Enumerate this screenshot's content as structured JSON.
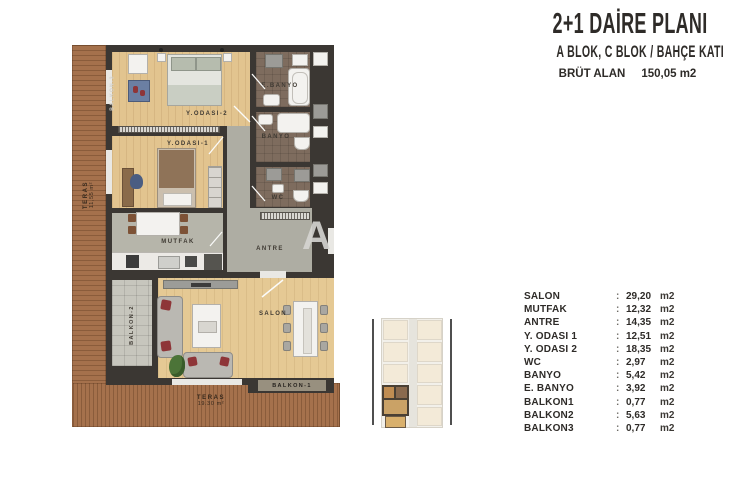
{
  "header": {
    "title": "2+1 DAİRE PLANI",
    "subtitle": "A BLOK, C BLOK / BAHÇE KATI",
    "gross_area_label": "BRÜT ALAN",
    "gross_area_value": "150,05 m2"
  },
  "plan": {
    "rooms": {
      "bedroom2": "Y.ODASI-2",
      "bedroom1": "Y.ODASI-1",
      "kitchen": "MUTFAK",
      "hall": "ANTRE",
      "living": "SALON",
      "ensuite_bath": "E.BANYO",
      "bath": "BANYO",
      "wc": "WC",
      "balcony1": "BALKON-1",
      "balcony2": "BALKON-2",
      "balcony3": "BALKON-3"
    },
    "terrace_left": {
      "name": "TERAS",
      "area": "11,55 m²"
    },
    "terrace_bottom": {
      "name": "TERAS",
      "area": "19.30 m²"
    }
  },
  "watermark": "A",
  "areas": {
    "colon": ":",
    "unit": "m2",
    "rows": [
      {
        "name": "SALON",
        "value": "29,20"
      },
      {
        "name": "MUTFAK",
        "value": "12,32"
      },
      {
        "name": "ANTRE",
        "value": "14,35"
      },
      {
        "name": "Y. ODASI 1",
        "value": "12,51"
      },
      {
        "name": "Y. ODASI 2",
        "value": "18,35"
      },
      {
        "name": "WC",
        "value": "2,97"
      },
      {
        "name": "BANYO",
        "value": "5,42"
      },
      {
        "name": "E. BANYO",
        "value": "3,92"
      },
      {
        "name": "BALKON1",
        "value": "0,77"
      },
      {
        "name": "BALKON2",
        "value": "5,63"
      },
      {
        "name": "BALKON3",
        "value": "0,77"
      }
    ]
  },
  "colors": {
    "wall": "#3b3733",
    "wood_floor": "#e2c48f",
    "terrace_deck": "#a5714c",
    "kitchen_floor": "#b6b5aa",
    "bath_floor": "#7e6c5e",
    "balcony_tile": "#c7c6bd",
    "accent_red": "#8e3538",
    "text": "#2e2b28"
  }
}
